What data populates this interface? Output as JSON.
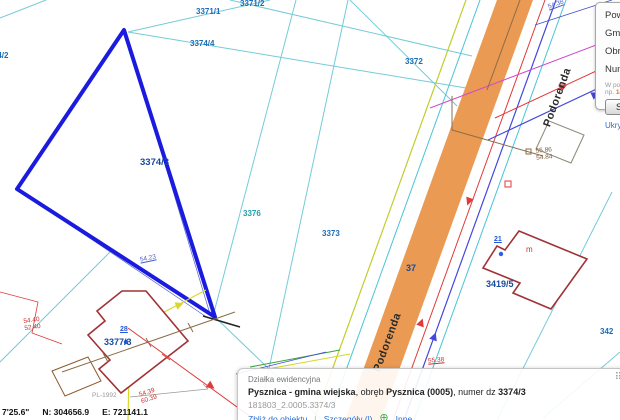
{
  "map": {
    "parcel_labels": {
      "p3371_2": "3371/2",
      "p3371_1": "3371/1",
      "p3374_4": "3374/4",
      "p3374_2": "3374/2",
      "p3372": "3372",
      "p3374_3": "3374/3",
      "p3376": "3376",
      "p3373": "3373",
      "p3377_3": "3377/3",
      "p3419_5": "3419/5",
      "p37": "37",
      "p342": "342"
    },
    "road_name": "Podorenda",
    "measurements": {
      "m54_23": "54.23",
      "m54_38": "54.38",
      "m55_38": "55.38",
      "m54_40": "54.40",
      "m52_40": "52.40",
      "m54_39": "54.39",
      "m60_39": "60.39",
      "m55_86": "55.86",
      "m54_84": "54.84"
    },
    "address_points": {
      "a21": "21",
      "a28": "28"
    },
    "building_letter_m": "m",
    "datum_label": "PL-1992",
    "colors": {
      "road": "#ea9a52",
      "selection": "#1b1be0",
      "parcel_line": "#74cbd8",
      "building": "#a03236"
    }
  },
  "statusbar": {
    "coord_suffix": "7'25.6\"",
    "northing": "N: 304656.9",
    "easting": "E: 721141.1"
  },
  "search_panel": {
    "fields": [
      "Powiat",
      "Gmina",
      "Obręb",
      "Numer"
    ],
    "hint_line1": "W polu",
    "hint_line2_prefix": "np. ",
    "hint_line2_value": "14",
    "button_label": "Szukaj",
    "hide_link": "Ukryj panel"
  },
  "popup": {
    "type_label": "Działka ewidencyjna",
    "name_bold": "Pysznica - gmina wiejska",
    "obreb_prefix": ", obręb ",
    "obreb_bold": "Pysznica (0005)",
    "numer_prefix": ", numer dz ",
    "numer_bold": "3374/3",
    "ident": "181803_2.0005.3374/3",
    "links": {
      "zoom_to": "Zbliż do obiektu",
      "details": "Szczegóły (l)",
      "other": "Inne"
    }
  }
}
